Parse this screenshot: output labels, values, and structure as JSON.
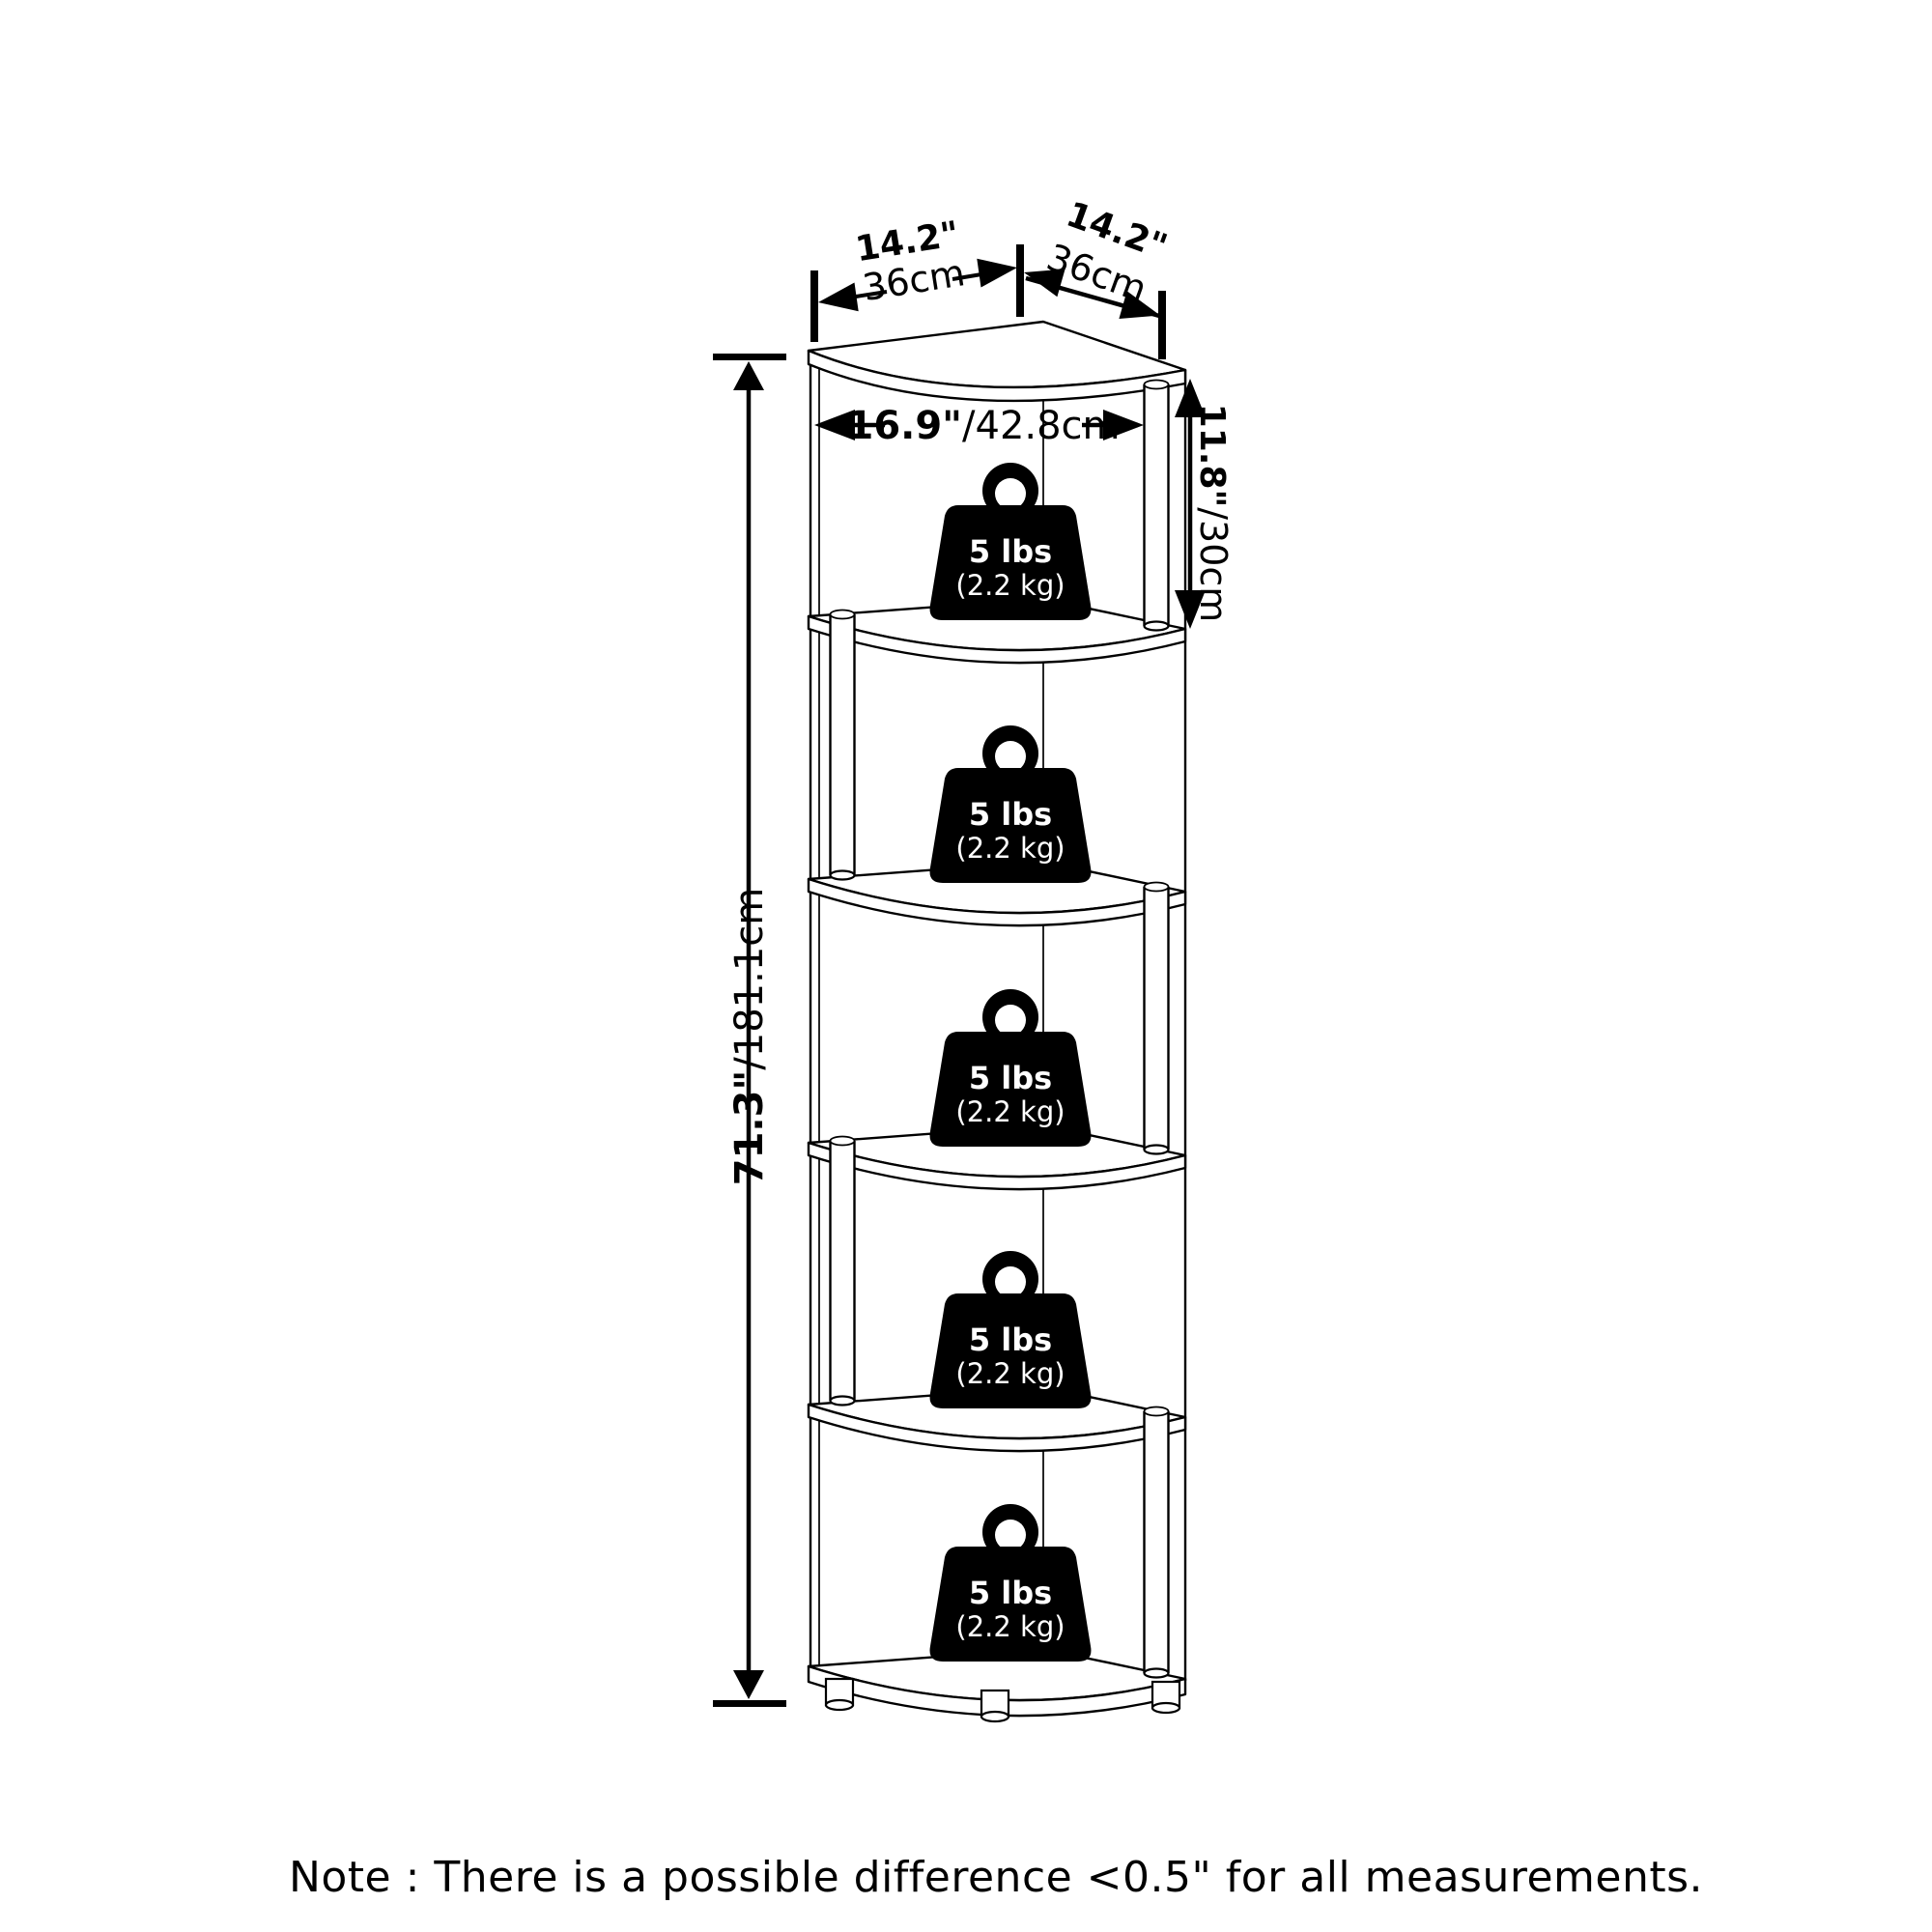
{
  "dims": {
    "top_left": {
      "inches": "14.2\"",
      "metric": "36cm"
    },
    "top_right": {
      "inches": "14.2\"",
      "metric": "36cm"
    },
    "shelf_width": {
      "inches": "16.9\"",
      "metric": "/42.8cm"
    },
    "tier_height": {
      "inches": "11.8\"",
      "metric": "/30cm"
    },
    "total_height": {
      "inches": "71.3\"",
      "metric": "/181.1cm"
    }
  },
  "weights": [
    {
      "lbs": "5 lbs",
      "kg": "(2.2 kg)"
    },
    {
      "lbs": "5 lbs",
      "kg": "(2.2 kg)"
    },
    {
      "lbs": "5 lbs",
      "kg": "(2.2 kg)"
    },
    {
      "lbs": "5 lbs",
      "kg": "(2.2 kg)"
    },
    {
      "lbs": "5 lbs",
      "kg": "(2.2 kg)"
    }
  ],
  "note": "Note : There is a possible difference <0.5\" for all measurements."
}
